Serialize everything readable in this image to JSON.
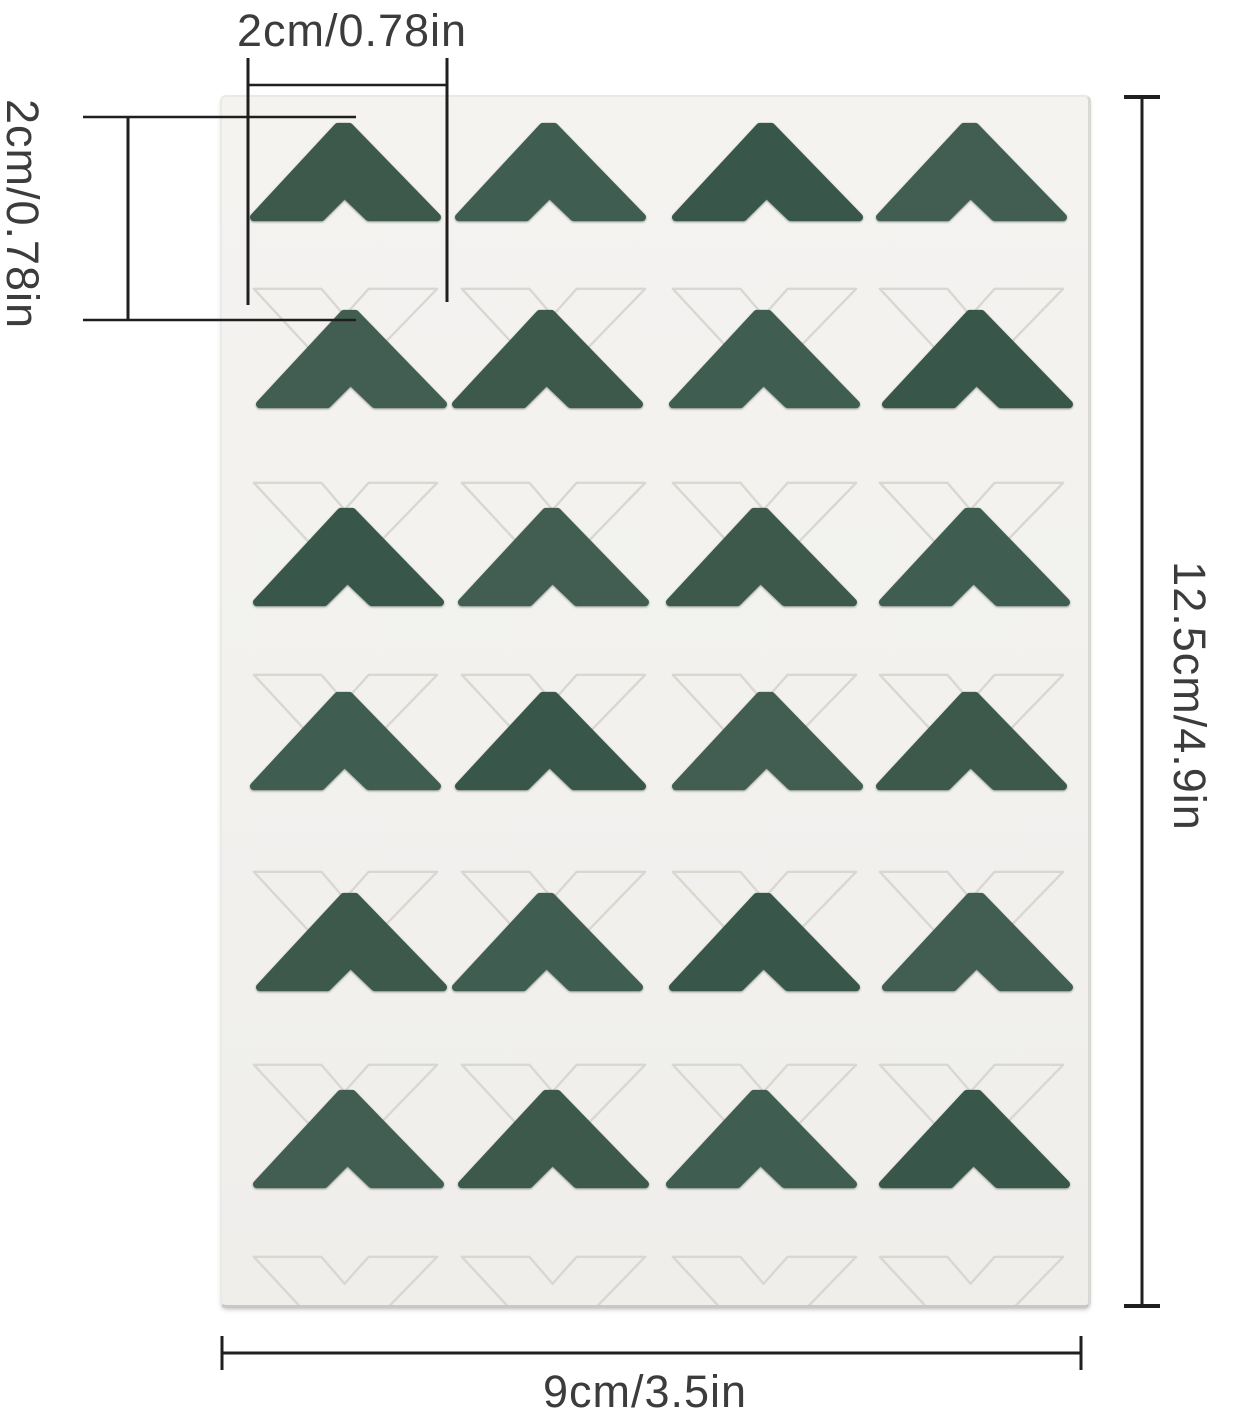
{
  "labels": {
    "top_width": "2cm/0.78in",
    "left_height": "2cm/0.78in",
    "right_height": "12.5cm/4.9in",
    "bottom_width": "9cm/3.5in"
  },
  "sheet": {
    "rows": 6,
    "cols": 4,
    "total_stickers": 24,
    "sticker_color": "#3e5b4f",
    "sticker_color_variants": [
      "#3c594c",
      "#3f5d50",
      "#39564a",
      "#425e52"
    ],
    "sheet_color": "#f2f1ee",
    "diecut_outline_color": "#d9d7d2",
    "dimension_line_color": "#1f1f1f",
    "page_background": "#ffffff"
  }
}
